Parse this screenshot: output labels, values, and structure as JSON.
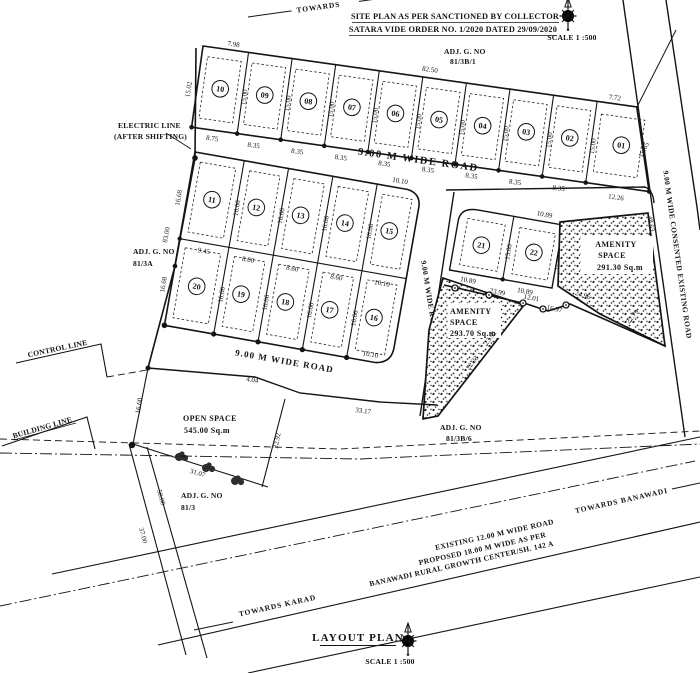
{
  "title_block": {
    "line1": "SITE PLAN AS PER  SANCTIONED BY COLLECTOR",
    "line2": "SATARA VIDE ORDER NO. 1/2020 DATED 29/09/2020",
    "scale": "SCALE 1 :500"
  },
  "footer": {
    "title": "LAYOUT PLAN",
    "scale": "SCALE 1 :500"
  },
  "directions": {
    "top": "TOWARDS",
    "banawadi": "TOWARDS BANAWADI",
    "karad": "TOWARDS KARAD"
  },
  "roads": {
    "wide_road": "9.00 M WIDE ROAD",
    "consented": "9.00 M WIDE CONSENTED EXISTING ROAD",
    "existing": "EXISTING 12.00 M WIDE ROAD",
    "proposed": "PROPOSED 18.00 M WIDE AS PER",
    "growth_center": "BANAWADI RURAL GROWTH CENTER/SH. 142 A"
  },
  "ref_lines": {
    "control": "CONTROL LINE",
    "building": "BUILDING LINE",
    "electric1": "ELECTRIC LINE",
    "electric2": "(AFTER SHIFTING)"
  },
  "adjacent": {
    "label": "ADJ. G. NO",
    "n1": "81/3B/1",
    "n2": "81/3A",
    "n3": "81/3",
    "n4": "81/3B/6"
  },
  "areas": {
    "amenity1": "AMENITY",
    "amenity2": "SPACE",
    "amenity_right_area": "291.30 Sq.m",
    "amenity_left_area": "293.70 Sq.m",
    "open1": "OPEN SPACE",
    "open2": "545.00 Sq.m"
  },
  "plots": [
    {
      "no": "01"
    },
    {
      "no": "02"
    },
    {
      "no": "03"
    },
    {
      "no": "04"
    },
    {
      "no": "05"
    },
    {
      "no": "06"
    },
    {
      "no": "07"
    },
    {
      "no": "08"
    },
    {
      "no": "09"
    },
    {
      "no": "10"
    },
    {
      "no": "11"
    },
    {
      "no": "12"
    },
    {
      "no": "13"
    },
    {
      "no": "14"
    },
    {
      "no": "15"
    },
    {
      "no": "16"
    },
    {
      "no": "17"
    },
    {
      "no": "18"
    },
    {
      "no": "19"
    },
    {
      "no": "20"
    },
    {
      "no": "21"
    },
    {
      "no": "22"
    }
  ],
  "dims": {
    "d798": "7.98",
    "d8250": "82.50",
    "d772": "7.72",
    "d1502": "15.02",
    "d1500": "15.00",
    "d1565": "15.65",
    "d875": "8.75",
    "d835": "8.35",
    "d1226": "12.26",
    "d8300": "83.00",
    "d1668": "16.68",
    "d1666": "16.66",
    "d945": "9.45",
    "d860": "8.60",
    "d1010": "10.10",
    "d1089": "10.89",
    "d2399": "23.99",
    "d1201": "12.01",
    "d1697": "16.97",
    "d2496": "24.96",
    "d2279": "22.79",
    "d2391": "23.91",
    "d2223": "22.23",
    "d4863": "48.63",
    "d3317": "33.17",
    "d404": "4.04",
    "d1660": "16.60",
    "d2292": "22.92",
    "d3107": "31.07",
    "d5000": "50.00",
    "d3700": "37.00"
  }
}
